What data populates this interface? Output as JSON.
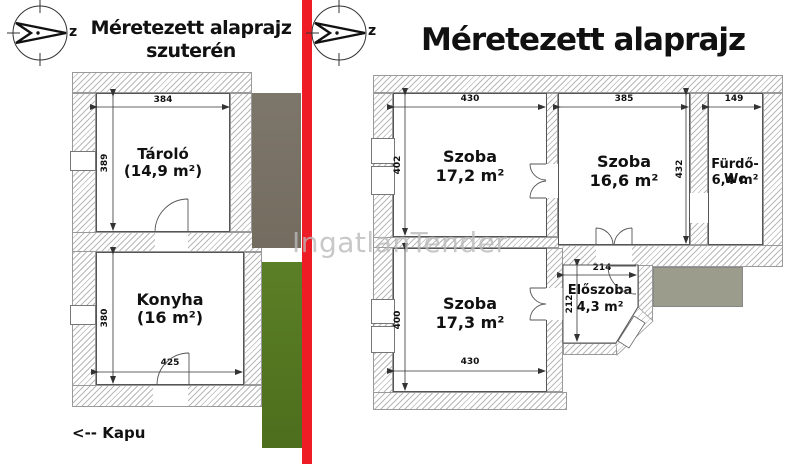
{
  "watermark": "IngatlanTender",
  "left_plan": {
    "title_line1": "Méretezett alaprajz",
    "title_line2": "szuterén",
    "compass_label": "z",
    "gate_label": "<-- Kapu",
    "rooms": [
      {
        "name": "Tároló",
        "area": "(14,9 m²)"
      },
      {
        "name": "Konyha",
        "area": "(16 m²)"
      }
    ],
    "dims": {
      "taro_width": "384",
      "taro_height": "389",
      "konyha_height": "380",
      "konyha_width": "425"
    }
  },
  "right_plan": {
    "title": "Méretezett alaprajz",
    "compass_label": "z",
    "rooms": [
      {
        "name": "Szoba",
        "area": "17,2 m²"
      },
      {
        "name": "Szoba",
        "area": "16,6 m²"
      },
      {
        "name": "Fürdő-Wc",
        "area": "6,4 m²"
      },
      {
        "name": "Szoba",
        "area": "17,3 m²"
      },
      {
        "name": "Előszoba",
        "area": "4,3 m²"
      }
    ],
    "dims": {
      "room1_width": "430",
      "room1_height": "402",
      "room2_width": "385",
      "room2_height": "432",
      "room3_width": "149",
      "room4_height": "400",
      "room4_width": "430",
      "room5_width": "214",
      "room5_height": "212"
    }
  },
  "colors": {
    "divider_red": "#ee1c24",
    "photo_brown": "#7b7468",
    "photo_green": "#567c22",
    "terrace_grey": "#9c9c8c"
  }
}
